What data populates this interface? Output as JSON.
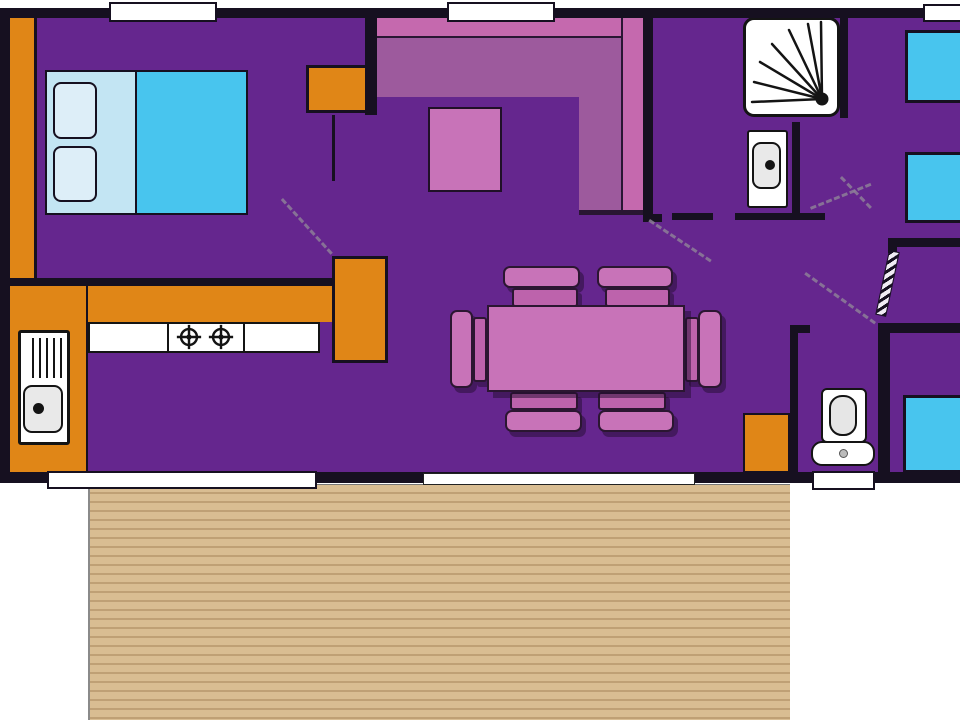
{
  "plan": {
    "kind": "mobile-home-floorplan",
    "rooms": [
      "bedroom-1",
      "living-room",
      "kitchen",
      "dining-area",
      "shower-room",
      "hallway",
      "wc",
      "bedroom-2",
      "bedroom-3",
      "terrace-deck"
    ],
    "fixtures": [
      "double-bed",
      "pillows",
      "wardrobe",
      "dresser",
      "corner-sofa",
      "coffee-table",
      "kitchen-counter",
      "kitchen-sink",
      "hob-burners",
      "fridge",
      "dining-table",
      "dining-chairs",
      "shower",
      "washbasin",
      "toilet",
      "single-bed",
      "single-bed",
      "single-bed",
      "deck-planks"
    ],
    "openings": [
      "window",
      "window",
      "window",
      "sliding-bay-door",
      "terrace-door",
      "wc-window",
      "door-swing",
      "door-swing",
      "door-swing",
      "door-swing",
      "open-door-leaf"
    ]
  },
  "palette": {
    "floor": "#65268e",
    "wall": "#161020",
    "orange": "#e08617",
    "deck": "#d9bd92",
    "deck_stripe": "#bfa075",
    "cyan": "#48c5ee",
    "bed_sheet": "#c3e5f3",
    "pillow": "#ddeef8",
    "sofa_back": "#c569ae",
    "sofa_seat": "#9d5a9d",
    "pink": "#c873b8",
    "chair_seat": "#bd63ac",
    "shadow": "rgba(35,12,48,0.5)",
    "white": "#ffffff",
    "fixture_grey": "#e9e9e9",
    "dash": "#8d7f98"
  }
}
